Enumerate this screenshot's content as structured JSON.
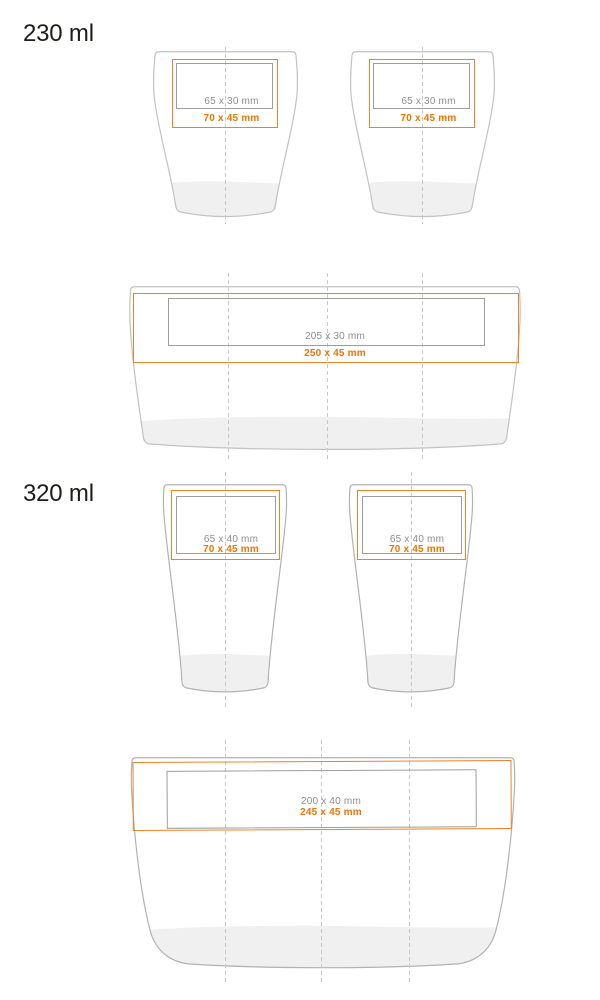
{
  "sections": [
    {
      "label": "230 ml",
      "front": {
        "print_area": "65 x 30 mm",
        "max_area": "70 x 45 mm"
      },
      "wrap": {
        "print_area": "205 x 30 mm",
        "max_area": "250 x 45 mm"
      }
    },
    {
      "label": "320 ml",
      "front": {
        "print_area": "65 x 40 mm",
        "max_area": "70 x 45 mm"
      },
      "wrap": {
        "print_area": "200 x 40 mm",
        "max_area": "245 x 45 mm"
      }
    }
  ],
  "colors": {
    "print_area_gray_text": "#8e8e8e",
    "print_area_gray_border": "#9d9d9d",
    "max_area_orange_text": "#ee7405",
    "max_area_orange_border": "#ef8228",
    "cup_outline_230": "#c2c2c2",
    "cup_outline_320": "#b2b2b2",
    "cup_base_shade": "#f0f0f0",
    "center_guide_dash": "#c9c9c9",
    "section_label_text": "#1d1d1b"
  }
}
